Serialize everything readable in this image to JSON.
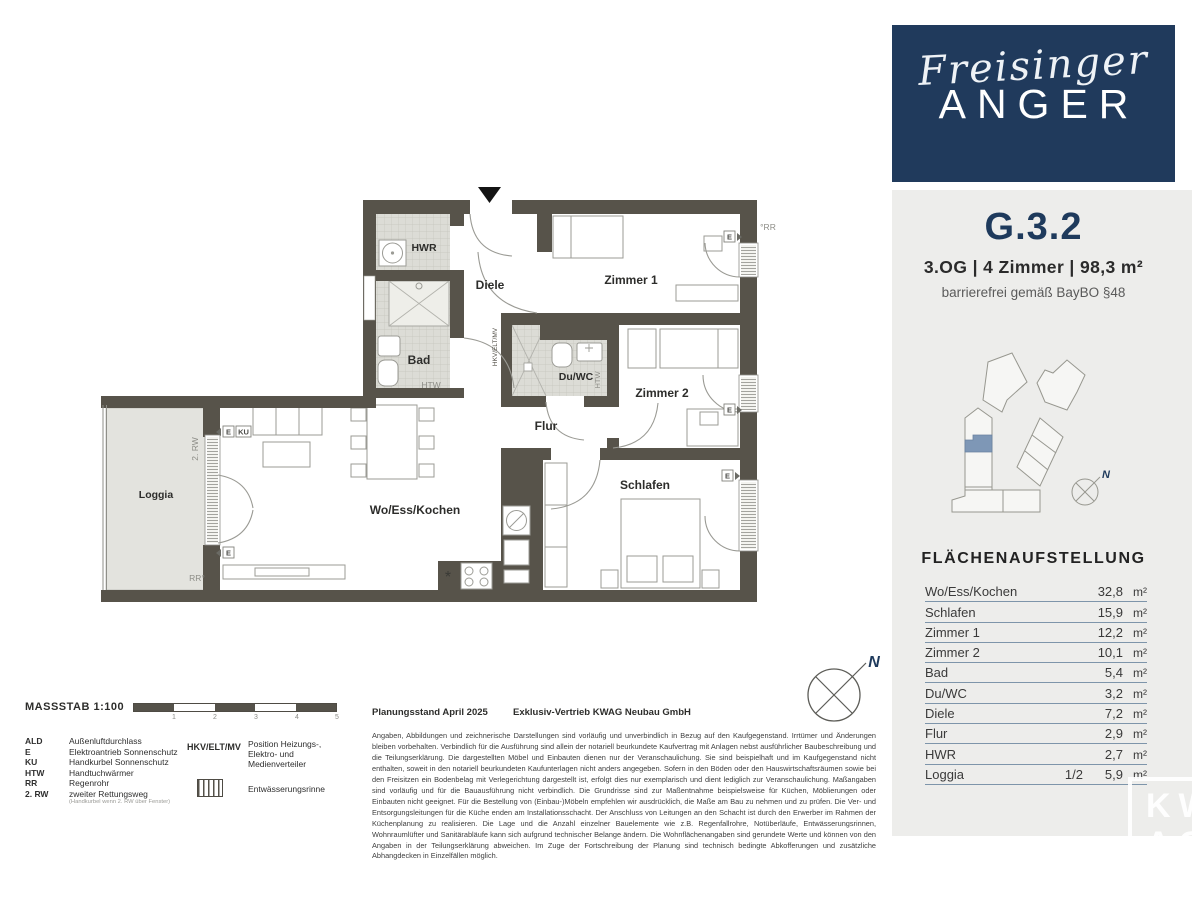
{
  "branding": {
    "script": "Freisinger",
    "caps": "ANGER"
  },
  "unit_header": {
    "id": "G.3.2",
    "specs": "3.OG  |  4 Zimmer  |  98,3 m²",
    "note": "barrierefrei gemäß BayBO §48"
  },
  "area_table": {
    "title": "FLÄCHENAUFSTELLUNG",
    "rows": [
      {
        "label": "Wo/Ess/Kochen",
        "share": "",
        "value": "32,8",
        "unit": "m²"
      },
      {
        "label": "Schlafen",
        "share": "",
        "value": "15,9",
        "unit": "m²"
      },
      {
        "label": "Zimmer 1",
        "share": "",
        "value": "12,2",
        "unit": "m²"
      },
      {
        "label": "Zimmer 2",
        "share": "",
        "value": "10,1",
        "unit": "m²"
      },
      {
        "label": "Bad",
        "share": "",
        "value": "5,4",
        "unit": "m²"
      },
      {
        "label": "Du/WC",
        "share": "",
        "value": "3,2",
        "unit": "m²"
      },
      {
        "label": "Diele",
        "share": "",
        "value": "7,2",
        "unit": "m²"
      },
      {
        "label": "Flur",
        "share": "",
        "value": "2,9",
        "unit": "m²"
      },
      {
        "label": "HWR",
        "share": "",
        "value": "2,7",
        "unit": "m²"
      },
      {
        "label": "Loggia",
        "share": "1/2",
        "value": "5,9",
        "unit": "m²"
      }
    ]
  },
  "plan": {
    "labels": {
      "hwr": "HWR",
      "diele": "Diele",
      "zimmer1": "Zimmer 1",
      "bad": "Bad",
      "htw": "HTW",
      "duwc": "Du/WC",
      "flur": "Flur",
      "zimmer2": "Zimmer 2",
      "schlafen": "Schlafen",
      "wohnen": "Wo/Ess/Kochen",
      "loggia": "Loggia",
      "rw2": "2. RW",
      "rr_bottom": "RR°",
      "rr_top": "°RR",
      "hkv": "HKV/ELT/MV",
      "e": "E",
      "ku": "KU",
      "north": "N",
      "kitchen_star": "*"
    }
  },
  "legend": {
    "massstab": "MASSSTAB 1:100",
    "ticks": [
      "1",
      "2",
      "3",
      "4",
      "5"
    ],
    "items": [
      {
        "abbr": "ALD",
        "desc": "Außenluftdurchlass"
      },
      {
        "abbr": "E",
        "desc": "Elektroantrieb Sonnenschutz"
      },
      {
        "abbr": "KU",
        "desc": "Handkurbel Sonnenschutz"
      },
      {
        "abbr": "HTW",
        "desc": "Handtuchwärmer"
      },
      {
        "abbr": "RR",
        "desc": "Regenrohr"
      },
      {
        "abbr": "2. RW",
        "desc": "zweiter Rettungsweg"
      }
    ],
    "note": "(Handkurbel wenn 2. RW über Fenster)",
    "hkv_abbr": "HKV/ELT/MV",
    "hkv_desc": "Position Heizungs-, Elektro- und Medienverteiler",
    "rinne": "Entwässerungsrinne"
  },
  "footer": {
    "planungsstand": "Planungsstand April 2025",
    "vertrieb": "Exklusiv-Vertrieb  KWAG Neubau GmbH",
    "disclaimer": "Angaben, Abbildungen und zeichnerische Darstellungen sind vorläufig und unverbindlich in Bezug auf den Kaufgegenstand. Irrtümer und Änderungen bleiben vorbehalten. Verbindlich für die Ausführung sind allein der notariell beurkundete Kaufvertrag mit Anlagen nebst ausführlicher Baubeschreibung und die Teilungserklärung. Die dargestellten Möbel und Einbauten dienen nur der Veranschaulichung. Sie sind beispielhaft und im Kaufgegenstand nicht enthalten, soweit in den notariell beurkundeten Kaufunterlagen nicht anders angegeben. Sofern in den Böden oder den Hauswirtschaftsräumen sowie bei den Freisitzen ein Bodenbelag mit Verlegerichtung dargestellt ist, erfolgt dies nur exemplarisch und dient lediglich zur Veranschaulichung. Maßangaben sind vorläufig und für die Bauausführung nicht verbindlich. Die Grundrisse sind zur Maßentnahme beispielsweise für Küchen, Möblierungen oder Einbauten nicht geeignet. Für die Bestellung von (Einbau-)Möbeln empfehlen wir ausdrücklich, die Maße am Bau zu nehmen und zu prüfen. Die Ver- und Entsorgungsleitungen für die Küche enden am Installationsschacht. Der Anschluss von Leitungen an den Schacht ist durch den Erwerber im Rahmen der Küchenplanung zu realisieren. Die Lage und die Anzahl einzelner Bauelemente wie z.B. Regenfallrohre, Notüberläufe, Entwässerungsrinnen, Wohnraumlüfter und Sanitärabläufe kann sich aufgrund technischer Belange ändern. Die Wohnflächenangaben sind gerundete Werte und können von den Angaben in der Teilungserklärung abweichen. Im Zuge der Fortschreibung der Planung sind technisch bedingte Abkofferungen und zusätzliche Abhangdecken in Einzelfällen möglich."
  },
  "watermark": {
    "line1": "KW",
    "line2": "AG"
  },
  "colors": {
    "navy": "#203a5c",
    "wall": "#57534a",
    "highlight_unit": "#7e97b6",
    "table_line": "#7e95aa",
    "panel": "#ededeb"
  }
}
